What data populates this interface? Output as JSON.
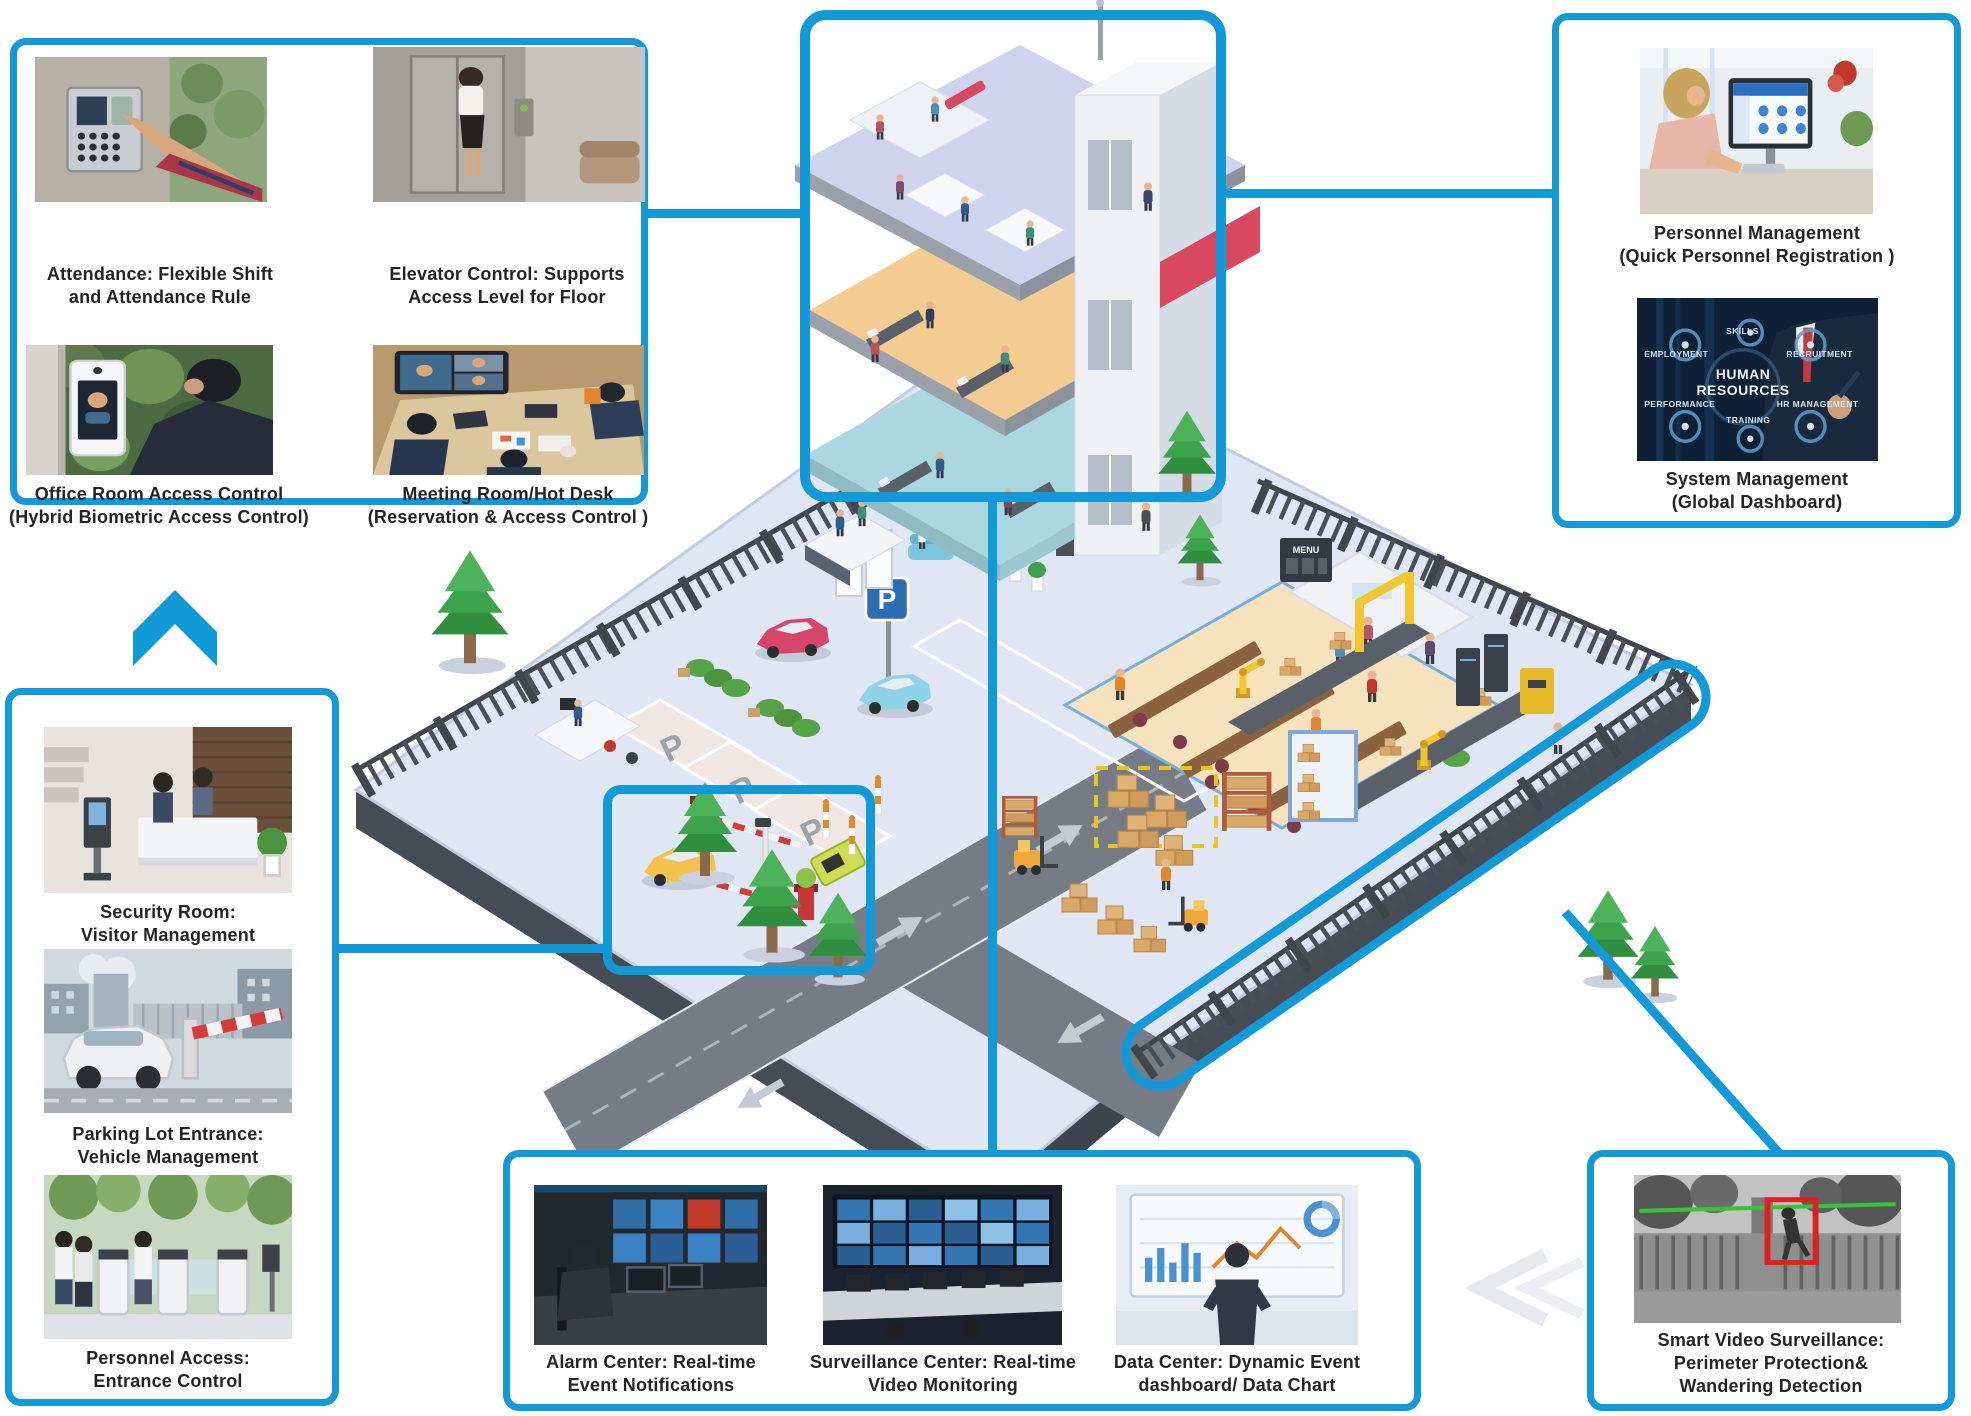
{
  "accent_color": "#1199d8",
  "boxes": {
    "access_control": {
      "items": [
        {
          "caption": "Attendance: Flexible Shift\nand Attendance Rule"
        },
        {
          "caption": "Elevator Control: Supports\nAccess Level for Floor"
        },
        {
          "caption": "Office Room Access Control\n(Hybrid Biometric Access Control)"
        },
        {
          "caption": "Meeting Room/Hot Desk\n(Reservation & Access Control )"
        }
      ]
    },
    "management": {
      "items": [
        {
          "caption": "Personnel Management\n(Quick Personnel Registration )"
        },
        {
          "caption": "System Management\n(Global Dashboard)"
        }
      ]
    },
    "entrance": {
      "items": [
        {
          "caption": "Security Room:\nVisitor Management"
        },
        {
          "caption": "Parking Lot Entrance:\nVehicle Management"
        },
        {
          "caption": "Personnel Access:\nEntrance Control"
        }
      ]
    },
    "centers": {
      "items": [
        {
          "caption": "Alarm Center: Real-time\nEvent Notifications"
        },
        {
          "caption": "Surveillance Center: Real-time\nVideo Monitoring"
        },
        {
          "caption": "Data Center: Dynamic Event\ndashboard/ Data Chart"
        }
      ]
    },
    "video": {
      "items": [
        {
          "caption": "Smart Video Surveillance:\nPerimeter Protection&\nWandering Detection"
        }
      ]
    }
  },
  "hr_graphic": {
    "center": "HUMAN RESOURCES",
    "labels": [
      "EMPLOYMENT",
      "SKILLS",
      "RECRUITMENT",
      "PERFORMANCE",
      "TRAINING",
      "HR MANAGEMENT"
    ]
  },
  "scene": {
    "parking_sign": "P",
    "parking_mark": "P",
    "menu_board": "MENU"
  }
}
